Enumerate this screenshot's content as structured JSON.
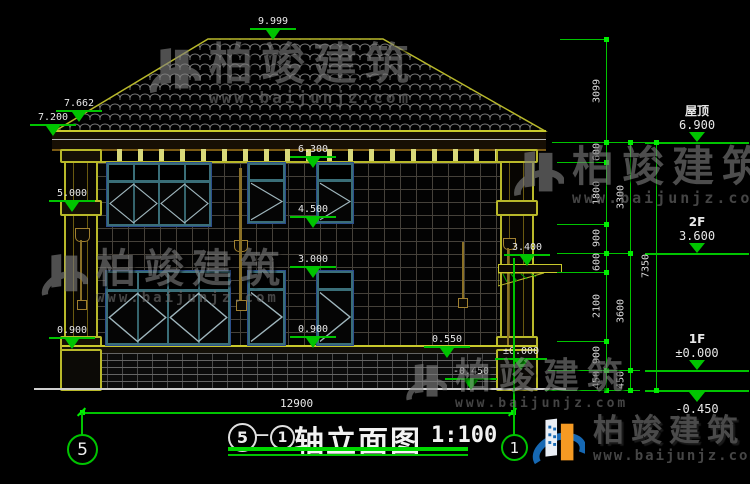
{
  "drawing": {
    "title": "轴立面图",
    "scale": "1:100",
    "axis_start": "5",
    "axis_end": "1",
    "dash": "—",
    "overall_width_dim": "12900"
  },
  "levels": {
    "ridge": "9.999",
    "roof_upper": "7.662",
    "eave": "7.200",
    "f2_window_head": "6.300",
    "pilaster_cap": "5.000",
    "f2_window_sill": "4.500",
    "canopy": "3.400",
    "f1_window_head": "3.000",
    "f1_window_sill": "0.900",
    "plinth_top": "0.550",
    "ground_floor": "±0.000",
    "site": "-0.450"
  },
  "floor_markers": [
    {
      "name": "屋顶",
      "value": "6.900"
    },
    {
      "name": "2F",
      "value": "3.600"
    },
    {
      "name": "1F",
      "value": "±0.000"
    },
    {
      "name": "",
      "value": "-0.450"
    }
  ],
  "dim_chain_inner": [
    "3099",
    "600",
    "1800",
    "900",
    "600",
    "2100",
    "900",
    "450"
  ],
  "dim_chain_middle": [
    "3300",
    "3600",
    "450"
  ],
  "dim_chain_outer": [
    "7350"
  ],
  "watermark": {
    "brand": "柏竣建筑",
    "url": "www.baijunjz.com"
  },
  "colors": {
    "dim_green": "#00c400",
    "outline_yellow": "#c9c92c",
    "frame_teal": "#3a6e78",
    "frame_navy": "#2b4e8c",
    "logo_blue": "#1668b3",
    "logo_orange": "#f59a23"
  }
}
